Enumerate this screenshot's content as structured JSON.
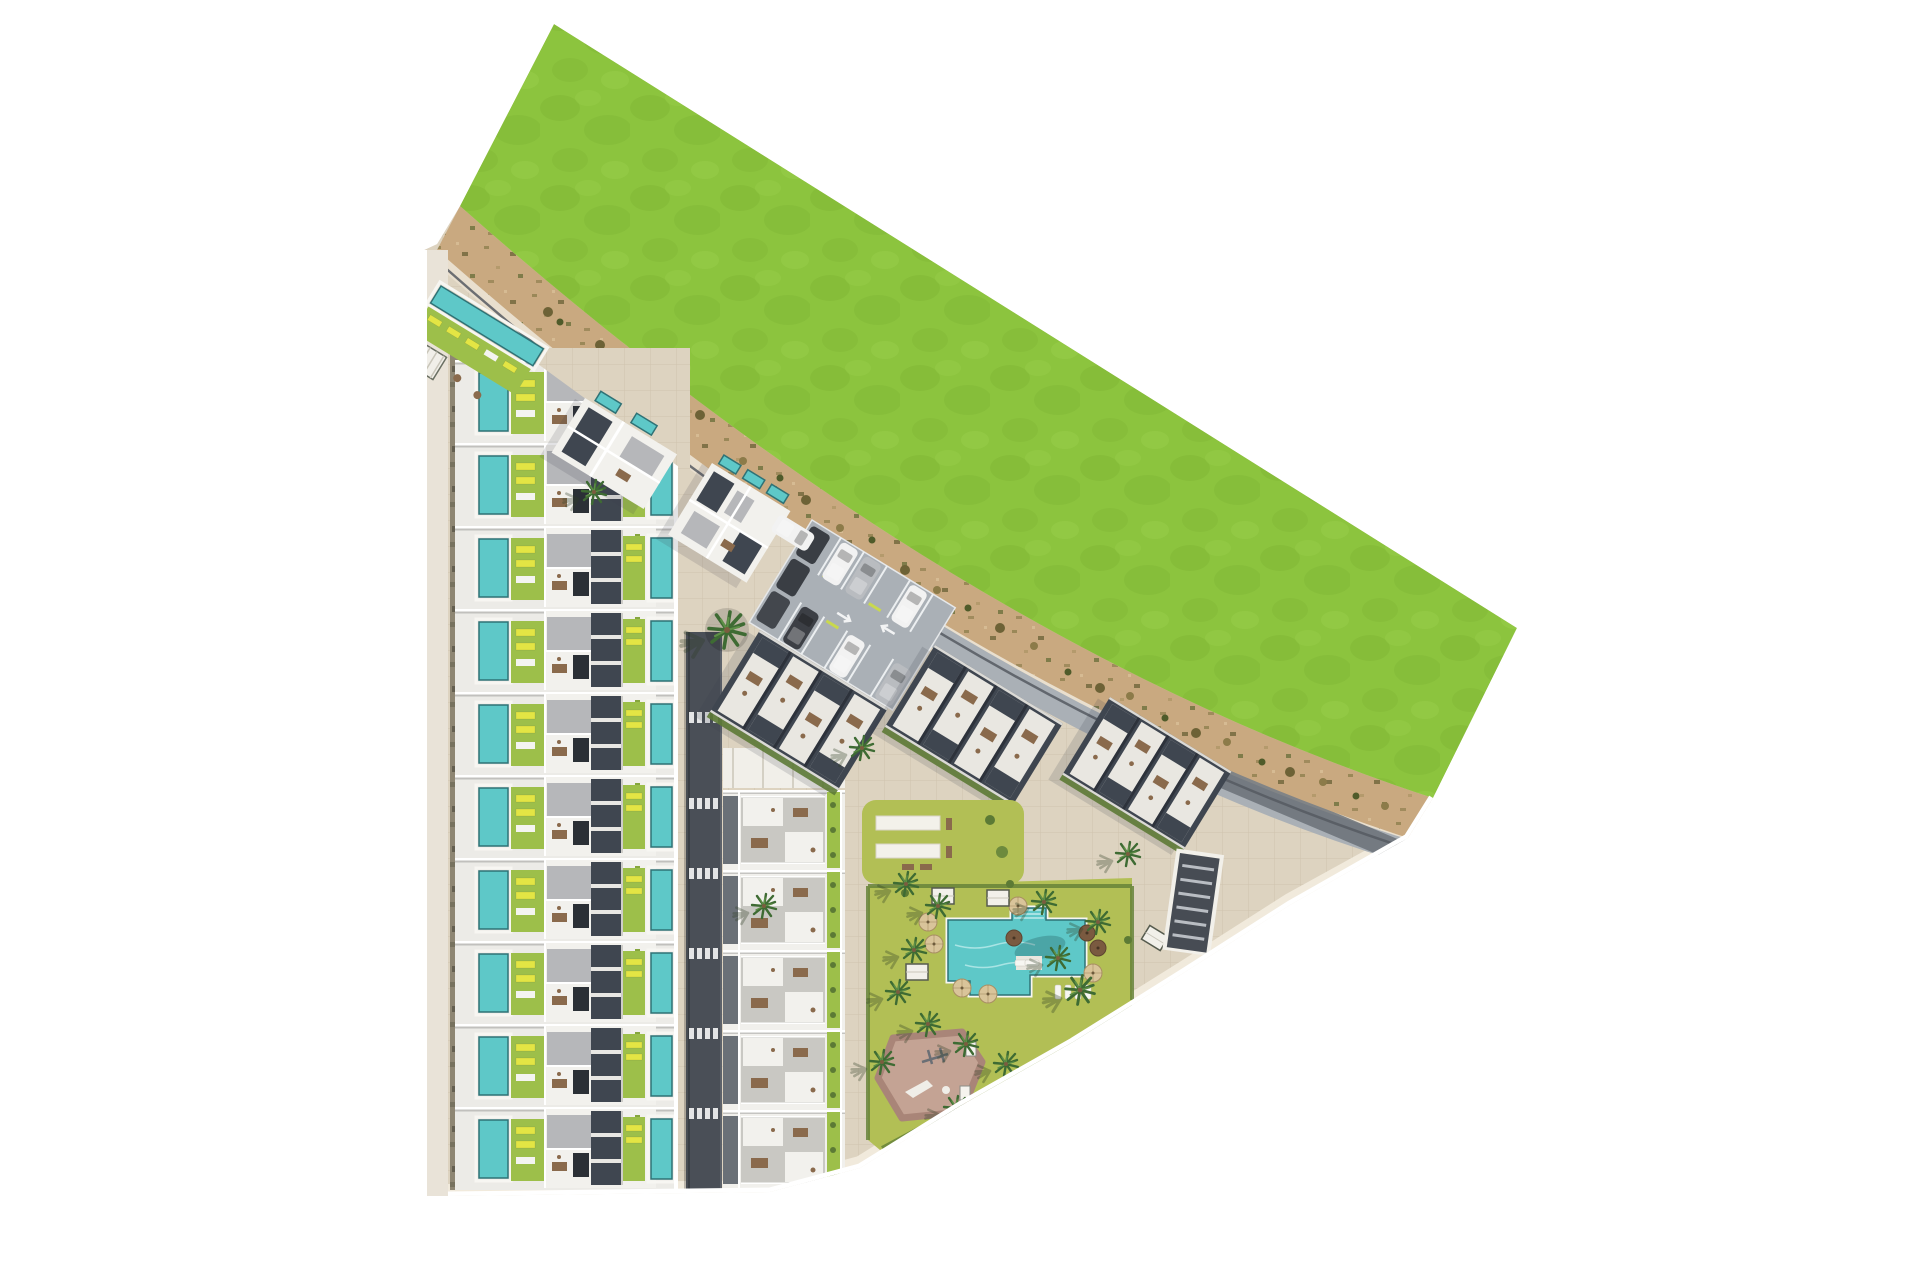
{
  "page": {
    "title": "Aerial masterplan rendering of a residential development",
    "background": "#ffffff"
  },
  "colors": {
    "grass": "#8cc43e",
    "grass2": "#7cb232",
    "grass3": "#9cd14f",
    "dirt": "#c9a980",
    "dirt2": "#8c7b4c",
    "pave": "#ddd3c0",
    "pave2": "#e9dfce",
    "road": "#4a4f57",
    "asphalt": "#aab0b6",
    "white_roof": "#f2f1ed",
    "gray_roof": "#b6b7ba",
    "dark_wall": "#3f4650",
    "pool": "#5ec8c8",
    "pool_rim": "#2f7276",
    "garden": "#9dbf4a",
    "lawn": "#b2bf55",
    "hedge": "#66833a",
    "lounger": "#e3e544",
    "wood": "#8a6a4c",
    "playground": "#c4a394",
    "playground_rim": "#a98578",
    "palm": "#3e6b33",
    "palm2": "#5d8f46",
    "parasol": "#d9c49a",
    "curb": "#f1ebdd"
  },
  "regions": {
    "green_field": "Open green field",
    "dirt_path": "Unpaved perimeter path with shrubs",
    "row_houses": "Terraced houses with private pools and gardens",
    "phase_block": "Apartment block with roof terraces",
    "roof_blocks": "Apartment blocks along the boundary path",
    "corner_pool": "Corner lap pool and sun deck",
    "cluster_a": "Housing cluster",
    "cluster_b": "Housing cluster with private pools",
    "parking": "Surface parking lot",
    "access_road": "Internal access road",
    "amenity_garden": "Communal landscaped garden",
    "pergola_lawn": "Lawn with shade pergolas",
    "pool": "Communal swimming pool",
    "playground": "Children's playground",
    "ramp": "Basement parking ramp",
    "promenade": "Pedestrian promenade"
  },
  "counts": {
    "house_rows": 10,
    "phase_units": 5,
    "roof_blocks": 3,
    "housing_clusters": 2,
    "parking_vehicles": 10,
    "crosswalks": 6,
    "parasols": 9,
    "cabanas": 4,
    "palm_trees": 19,
    "perimeter_bushes": 27,
    "pergola_slabs": 2,
    "pools_communal": 2
  }
}
